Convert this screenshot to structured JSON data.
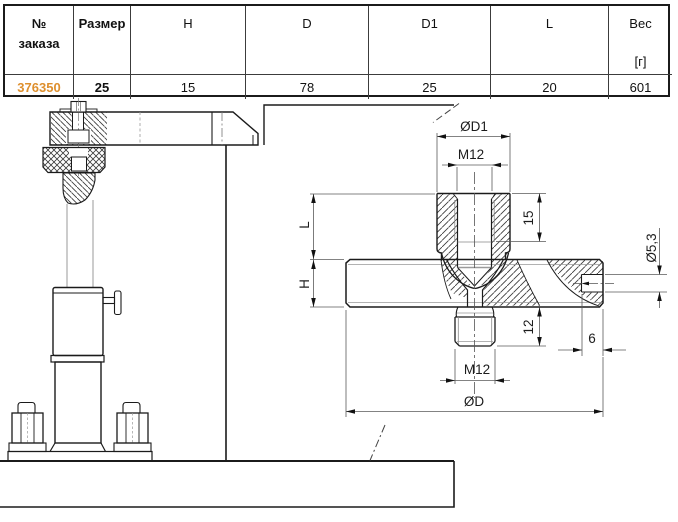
{
  "table": {
    "headers": [
      {
        "id": "order",
        "lines": [
          "№",
          "заказа"
        ]
      },
      {
        "id": "size",
        "label": "Размер"
      },
      {
        "id": "H",
        "label": "H"
      },
      {
        "id": "D",
        "label": "D"
      },
      {
        "id": "D1",
        "label": "D1"
      },
      {
        "id": "L",
        "label": "L"
      },
      {
        "id": "weight",
        "label": "Вес",
        "unit": "[г]"
      }
    ],
    "row": [
      "376350",
      "25",
      "15",
      "78",
      "25",
      "20",
      "601"
    ]
  },
  "drawing": {
    "dims": {
      "d1": "ØD1",
      "m12_top": "M12",
      "thread_depth": "15",
      "boss_height": "L",
      "disc_height": "H",
      "hole_dia": "Ø5,3",
      "stud_len": "12",
      "m12_bottom": "M12",
      "hole_depth": "6",
      "disc_dia": "ØD"
    }
  },
  "colors": {
    "order_number": "#DE8F2D",
    "line": "#1b1b1b"
  }
}
